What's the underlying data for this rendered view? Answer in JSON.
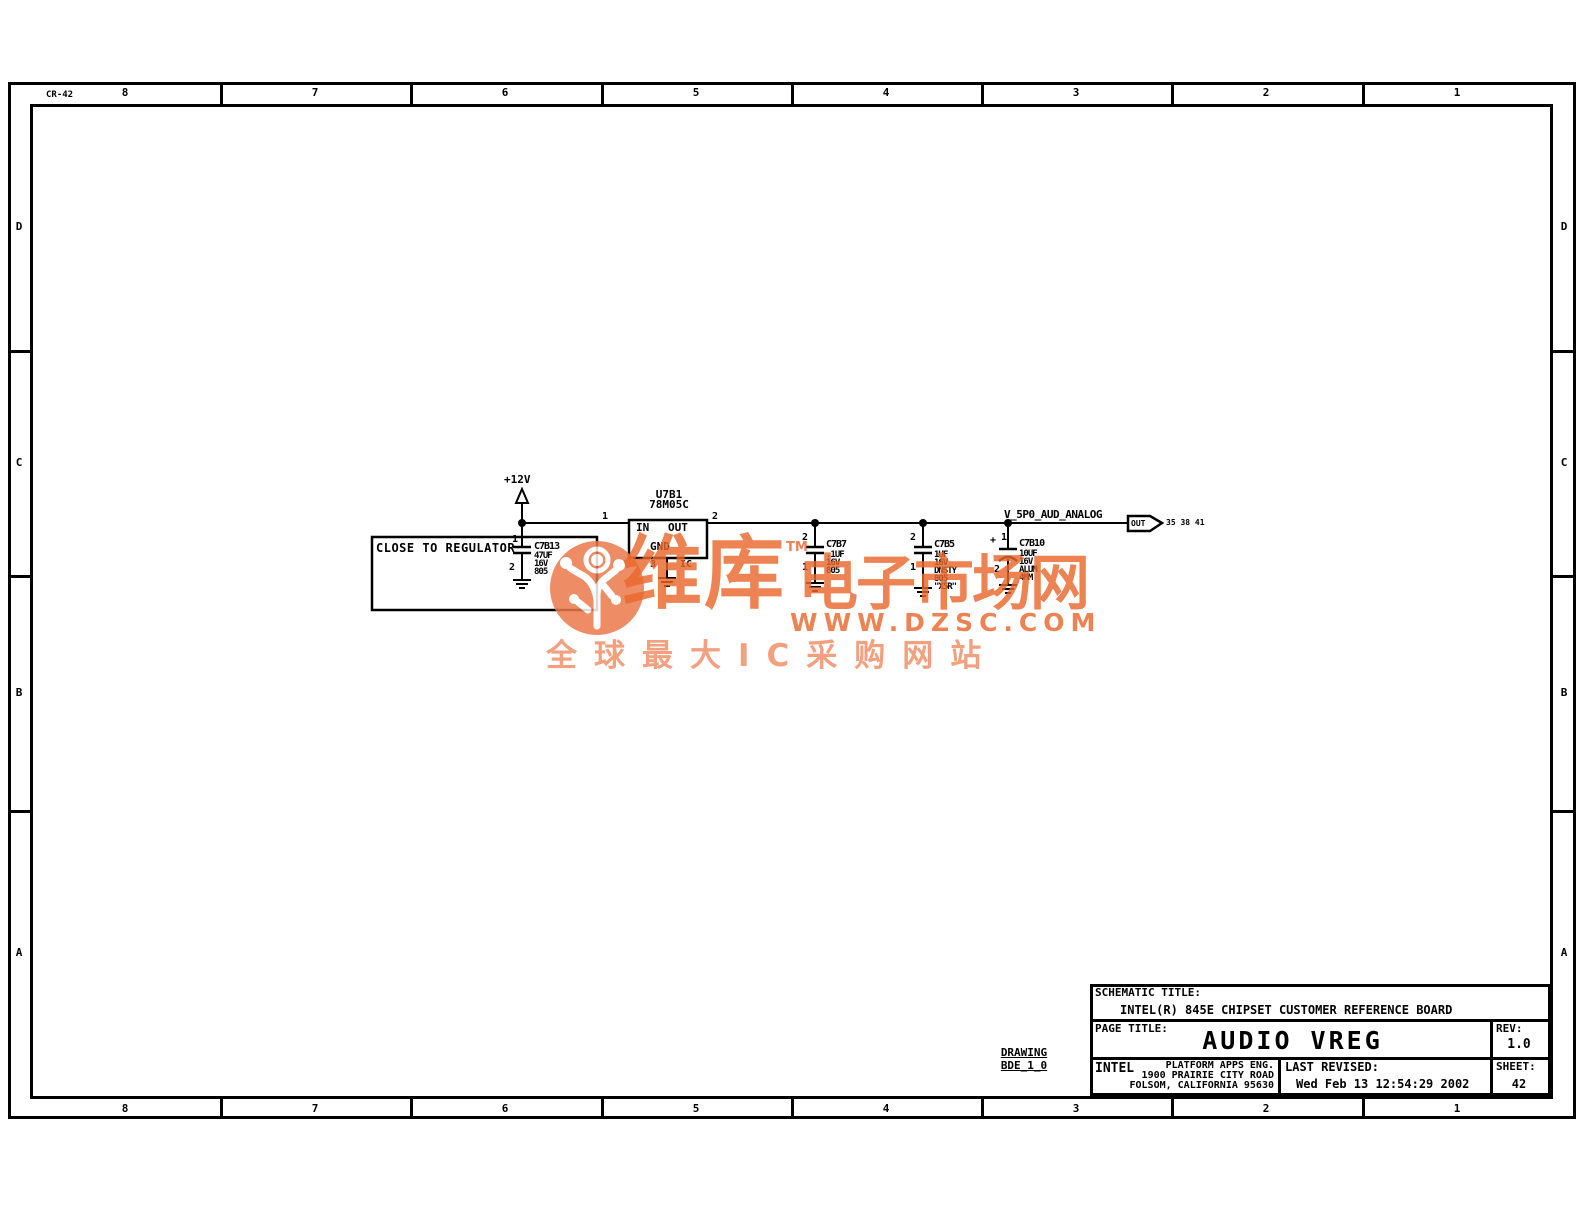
{
  "sheet": {
    "doc_code": "CR-42",
    "zone_columns": [
      "8",
      "7",
      "6",
      "5",
      "4",
      "3",
      "2",
      "1"
    ],
    "zone_rows": [
      "D",
      "C",
      "B",
      "A"
    ]
  },
  "schematic": {
    "power_net": "+12V",
    "note_box": "CLOSE TO REGULATOR",
    "regulator": {
      "refdes": "U7B1",
      "part": "78M05C",
      "pin_in_label": "IN",
      "pin_out_label": "OUT",
      "pin_gnd_label": "GND",
      "pin1": "1",
      "pin2": "2",
      "pin3": "3",
      "ic_label": "IC"
    },
    "caps": [
      {
        "refdes": "C7B13",
        "pin_top": "1",
        "pin_bottom": "2",
        "values": [
          "47UF",
          "16V",
          "805"
        ]
      },
      {
        "refdes": "C7B7",
        "pin_top": "2",
        "pin_bottom": "1",
        "values": [
          ".1UF",
          "16V",
          "805"
        ]
      },
      {
        "refdes": "C7B5",
        "pin_top": "2",
        "pin_bottom": "1",
        "values": [
          "1UF",
          "16V",
          "DNSTY",
          "805",
          "\"X5R\""
        ]
      },
      {
        "refdes": "C7B10",
        "polarity": "+",
        "pin_top": "1",
        "pin_bottom": "2",
        "values": [
          "10UF",
          "16V",
          "ALUM",
          "4MM"
        ]
      }
    ],
    "output_net": {
      "name": "V_5P0_AUD_ANALOG",
      "tag": "OUT",
      "sheet_refs": "35 38 41"
    }
  },
  "title_block": {
    "schematic_title_label": "SCHEMATIC TITLE:",
    "schematic_title": "INTEL(R) 845E CHIPSET CUSTOMER REFERENCE BOARD",
    "page_title_label": "PAGE TITLE:",
    "page_title": "AUDIO VREG",
    "rev_label": "REV:",
    "rev": "1.0",
    "company": "INTEL",
    "dept": "PLATFORM APPS ENG.",
    "address1": "1900 PRAIRIE CITY ROAD",
    "address2": "FOLSOM, CALIFORNIA 95630",
    "last_revised_label": "LAST REVISED:",
    "last_revised": "Wed Feb 13 12:54:29 2002",
    "sheet_label": "SHEET:",
    "sheet_number": "42"
  },
  "drawing_label": {
    "line1": "DRAWING",
    "line2": "BDE_1_0"
  },
  "watermark": {
    "brand": "维库",
    "brand2": "电子市场网",
    "tm": "TM",
    "url": "WWW.DZSC.COM",
    "tagline": "全球最大IC采购网站",
    "orange": "#e8682c"
  }
}
